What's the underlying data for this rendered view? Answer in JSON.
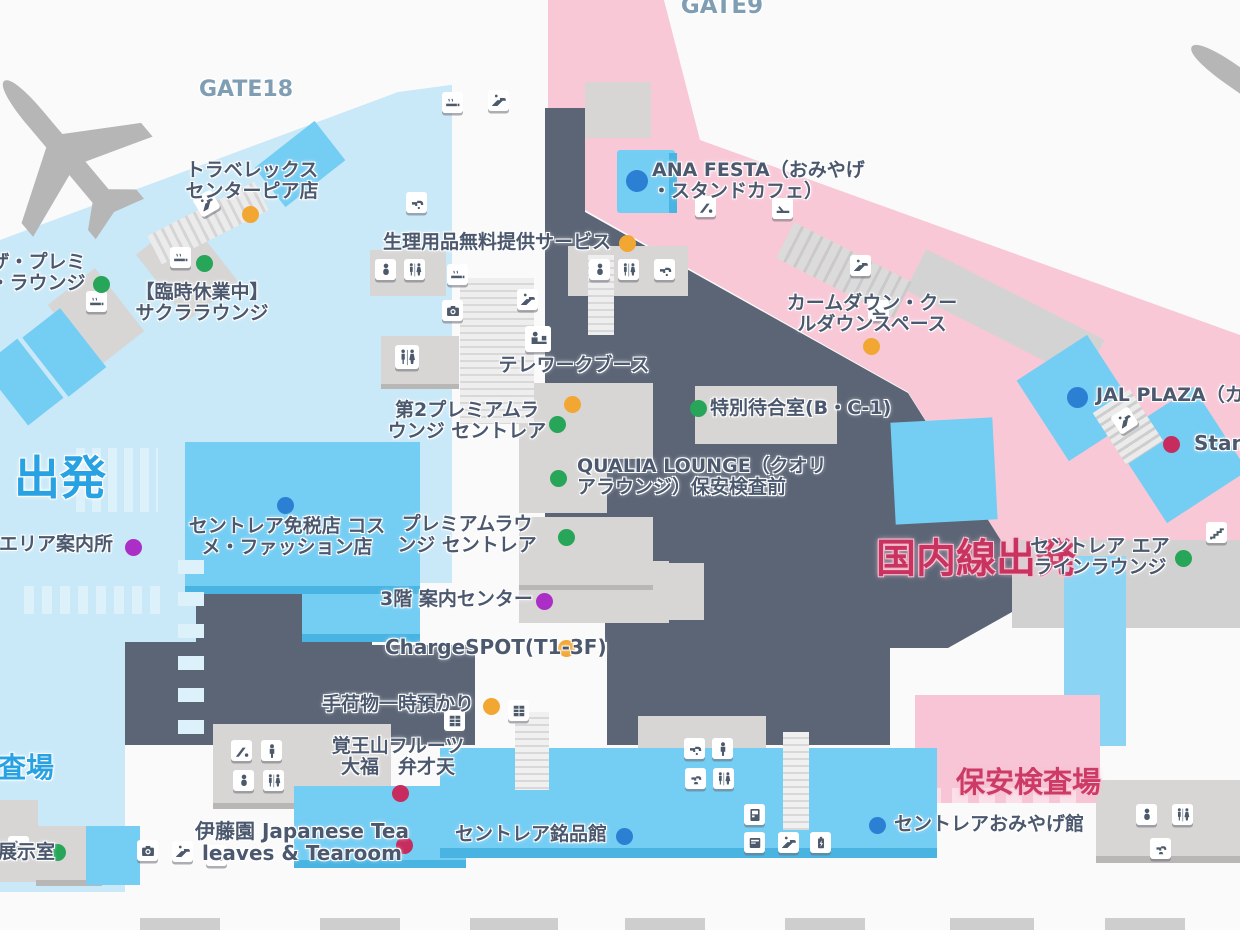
{
  "map": {
    "dot_colors": {
      "yellow": "#f2a733",
      "green": "#27a558",
      "blue": "#2b80d4",
      "purple": "#ab2fc6",
      "crimson": "#c62d5e"
    },
    "accent_colors": {
      "departures_blue": "#28a2e2",
      "domestic_crimson": "#c8335f",
      "gate_gray_blue": "#7f9db3",
      "international_area": "#c9e9f8",
      "domestic_area": "#f8c8d7",
      "secure_area": "#5b6576"
    },
    "labels": [
      {
        "id": "gate9-label",
        "lines": [
          "GATE9"
        ],
        "x": 722,
        "y": -6,
        "align": "center",
        "size": 23,
        "color": "#7f9db3"
      },
      {
        "id": "gate18-label",
        "lines": [
          "GATE18"
        ],
        "x": 246,
        "y": 78,
        "align": "center",
        "size": 22,
        "color": "#7f9db3"
      },
      {
        "id": "travelex-centrair-pier",
        "lines": [
          "トラベレックス",
          "センターピア店"
        ],
        "x": 252,
        "y": 160,
        "align": "center",
        "dot": {
          "color": "yellow",
          "x": 250,
          "y": 214
        }
      },
      {
        "id": "the-premium-lounge",
        "lines": [
          "ザ・プレミ",
          "・ラウンジ"
        ],
        "x": 38,
        "y": 252,
        "align": "center",
        "dot": {
          "color": "green",
          "x": 101,
          "y": 284
        }
      },
      {
        "id": "sakura-lounge-closed",
        "lines": [
          "【臨時休業中】",
          "サクララウンジ"
        ],
        "x": 202,
        "y": 282,
        "align": "center",
        "dot": {
          "color": "green",
          "x": 204,
          "y": 263
        }
      },
      {
        "id": "ana-festa-stand-cafe",
        "lines": [
          "ANA FESTA（おみやげ",
          "・スタンドカフェ）"
        ],
        "x": 652,
        "y": 160,
        "dot": {
          "color": "blue",
          "x": 637,
          "y": 181,
          "size": 22
        }
      },
      {
        "id": "sanitary-items-free-service",
        "lines": [
          "生理用品無料提供サービス"
        ],
        "x": 383,
        "y": 232,
        "dot": {
          "color": "yellow",
          "x": 627,
          "y": 243
        }
      },
      {
        "id": "calm-down-cool-down-space",
        "lines": [
          "カームダウン・クー",
          "ルダウンスペース"
        ],
        "x": 872,
        "y": 293,
        "align": "center",
        "dot": {
          "color": "yellow",
          "x": 871,
          "y": 346
        }
      },
      {
        "id": "telework-booth",
        "lines": [
          "テレワークブース"
        ],
        "x": 574,
        "y": 355,
        "align": "center",
        "dot": {
          "color": "yellow",
          "x": 572,
          "y": 404
        }
      },
      {
        "id": "premium-lounge-centrair-2",
        "lines": [
          "第2プレミアムラ",
          "ウンジ セントレア"
        ],
        "x": 467,
        "y": 400,
        "align": "center",
        "dot": {
          "color": "green",
          "x": 557,
          "y": 424
        }
      },
      {
        "id": "special-waiting-room",
        "lines": [
          "特別待合室(B・C-1)"
        ],
        "x": 710,
        "y": 398,
        "dot": {
          "color": "green",
          "x": 698,
          "y": 408
        }
      },
      {
        "id": "qualia-lounge",
        "lines": [
          "QUALIA LOUNGE（クオリ",
          "アラウンジ）保安検査前"
        ],
        "x": 577,
        "y": 456,
        "dot": {
          "color": "green",
          "x": 558,
          "y": 478
        }
      },
      {
        "id": "premium-lounge-centrair",
        "lines": [
          "プレミアムラウ",
          "ンジ セントレア"
        ],
        "x": 467,
        "y": 514,
        "align": "center",
        "dot": {
          "color": "green",
          "x": 566,
          "y": 537
        }
      },
      {
        "id": "centrair-duty-free-cosme-fashion",
        "lines": [
          "セントレア免税店 コス",
          "メ・ファッション店"
        ],
        "x": 287,
        "y": 516,
        "align": "center",
        "dot": {
          "color": "blue",
          "x": 285,
          "y": 505
        }
      },
      {
        "id": "restricted-area-info",
        "lines": [
          "限エリア案内所"
        ],
        "x": -20,
        "y": 534,
        "dot": {
          "color": "purple",
          "x": 133,
          "y": 547
        }
      },
      {
        "id": "departures-label",
        "lines": [
          "出発"
        ],
        "x": 14,
        "y": 453,
        "size": 46,
        "color": "#28a2e2"
      },
      {
        "id": "domestic-departures-label",
        "lines": [
          "国内線出発"
        ],
        "x": 876,
        "y": 537,
        "size": 40,
        "color": "#c8335f",
        "cls": "pinkhalo"
      },
      {
        "id": "jal-plaza-cafe",
        "lines": [
          "JAL PLAZA（カフ"
        ],
        "x": 1096,
        "y": 385,
        "dot": {
          "color": "blue",
          "x": 1077,
          "y": 397,
          "size": 21
        }
      },
      {
        "id": "stand-shop",
        "lines": [
          "Stand"
        ],
        "x": 1194,
        "y": 432,
        "size": 20,
        "dot": {
          "color": "crimson",
          "x": 1171,
          "y": 444
        }
      },
      {
        "id": "centrair-airline-lounge",
        "lines": [
          "セントレア エア",
          "ラインラウンジ"
        ],
        "x": 1100,
        "y": 536,
        "align": "center",
        "dot": {
          "color": "green",
          "x": 1183,
          "y": 558
        }
      },
      {
        "id": "info-center-3f",
        "lines": [
          "3階 案内センター"
        ],
        "x": 380,
        "y": 589,
        "dot": {
          "color": "purple",
          "x": 544,
          "y": 601
        }
      },
      {
        "id": "chargespot-t1-3f",
        "lines": [
          "ChargeSPOT(T1-3F)"
        ],
        "x": 385,
        "y": 636,
        "size": 20,
        "dot": {
          "color": "yellow",
          "x": 566,
          "y": 648
        }
      },
      {
        "id": "baggage-temporary-storage",
        "lines": [
          "手荷物一時預かり"
        ],
        "x": 322,
        "y": 694,
        "dot": {
          "color": "yellow",
          "x": 491,
          "y": 706
        }
      },
      {
        "id": "kakuozan-fruit-daifuku-benzaiten",
        "lines": [
          "覚王山フルーツ",
          "大福　弁才天"
        ],
        "x": 398,
        "y": 736,
        "align": "center",
        "dot": {
          "color": "crimson",
          "x": 400,
          "y": 793
        }
      },
      {
        "id": "itoen-japanese-tea-tearoom",
        "lines": [
          "伊藤園 Japanese Tea",
          "leaves & Tearoom"
        ],
        "x": 302,
        "y": 820,
        "align": "center",
        "size": 20,
        "dot": {
          "color": "crimson",
          "x": 404,
          "y": 845
        }
      },
      {
        "id": "centrair-meihinkan",
        "lines": [
          "セントレア銘品館"
        ],
        "x": 455,
        "y": 824,
        "dot": {
          "color": "blue",
          "x": 624,
          "y": 836
        }
      },
      {
        "id": "security-checkpoint-label",
        "lines": [
          "保安検査場"
        ],
        "x": 956,
        "y": 766,
        "size": 29,
        "color": "#cd3a66",
        "cls": "pinkhalo"
      },
      {
        "id": "centrair-omiyage-hall",
        "lines": [
          "セントレアおみやげ館"
        ],
        "x": 894,
        "y": 814,
        "dot": {
          "color": "blue",
          "x": 877,
          "y": 825
        }
      },
      {
        "id": "exhibition-room",
        "lines": [
          "展示室"
        ],
        "x": -2,
        "y": 842,
        "dot": {
          "color": "green",
          "x": 57,
          "y": 852
        }
      },
      {
        "id": "inspection-area-partial",
        "lines": [
          "検査場"
        ],
        "x": -30,
        "y": 752,
        "size": 28,
        "color": "#28a2e2"
      }
    ],
    "icons": [
      {
        "id": "smoking-room-icon",
        "g": "smoking",
        "x": 170,
        "y": 247
      },
      {
        "id": "escalator-icon",
        "g": "escalator",
        "x": 196,
        "y": 193,
        "rot": -30
      },
      {
        "id": "smoking-room-icon",
        "g": "smoking",
        "x": 86,
        "y": 291
      },
      {
        "id": "smoking-room-icon",
        "g": "smoking",
        "x": 442,
        "y": 92
      },
      {
        "id": "escalator-icon",
        "g": "escalator",
        "x": 488,
        "y": 90
      },
      {
        "id": "faucet-icon",
        "g": "faucet",
        "x": 406,
        "y": 192
      },
      {
        "id": "baby-care-icon",
        "g": "baby",
        "x": 375,
        "y": 259
      },
      {
        "id": "restroom-icon",
        "g": "restroom",
        "x": 404,
        "y": 259
      },
      {
        "id": "smoking-room-icon",
        "g": "smoking",
        "x": 447,
        "y": 264
      },
      {
        "id": "photo-booth-icon",
        "g": "photo",
        "x": 442,
        "y": 300
      },
      {
        "id": "restroom-icon",
        "g": "restroom",
        "x": 395,
        "y": 345,
        "size": 24
      },
      {
        "id": "escalator-icon",
        "g": "escalator",
        "x": 517,
        "y": 289
      },
      {
        "id": "telework-booth-icon",
        "g": "telework",
        "x": 525,
        "y": 326,
        "size": 26
      },
      {
        "id": "baby-care-icon",
        "g": "baby",
        "x": 589,
        "y": 259
      },
      {
        "id": "restroom-icon",
        "g": "restroom",
        "x": 618,
        "y": 259
      },
      {
        "id": "faucet-icon",
        "g": "faucet",
        "x": 654,
        "y": 259
      },
      {
        "id": "kids-play-area-icon",
        "g": "slide",
        "x": 695,
        "y": 196
      },
      {
        "id": "relaxation-seat-icon",
        "g": "seat",
        "x": 772,
        "y": 198
      },
      {
        "id": "escalator-icon",
        "g": "escalator",
        "x": 850,
        "y": 255
      },
      {
        "id": "calm-down-room-icon",
        "g": "seat",
        "x": 868,
        "y": 300
      },
      {
        "id": "escalator-icon",
        "g": "escalator",
        "x": 1114,
        "y": 410,
        "rot": -33
      },
      {
        "id": "stairs-icon",
        "g": "stairs",
        "x": 1206,
        "y": 522
      },
      {
        "id": "coin-locker-icon",
        "g": "locker",
        "x": 444,
        "y": 710
      },
      {
        "id": "coin-locker-icon",
        "g": "locker",
        "x": 508,
        "y": 700
      },
      {
        "id": "kids-slide-icon",
        "g": "slide",
        "x": 231,
        "y": 740
      },
      {
        "id": "mens-room-icon",
        "g": "man",
        "x": 261,
        "y": 740
      },
      {
        "id": "baby-care-icon",
        "g": "baby",
        "x": 233,
        "y": 770
      },
      {
        "id": "restroom-icon",
        "g": "restroom",
        "x": 263,
        "y": 770
      },
      {
        "id": "faucet-icon",
        "g": "faucet",
        "x": 684,
        "y": 738
      },
      {
        "id": "mens-room-icon",
        "g": "man",
        "x": 712,
        "y": 738
      },
      {
        "id": "drinking-fountain-icon",
        "g": "fountain",
        "x": 685,
        "y": 768
      },
      {
        "id": "restroom-icon",
        "g": "restroom",
        "x": 713,
        "y": 768
      },
      {
        "id": "vending-machine-icon",
        "g": "vending",
        "x": 744,
        "y": 804
      },
      {
        "id": "atm-icon",
        "g": "atm",
        "x": 744,
        "y": 832
      },
      {
        "id": "escalator-icon",
        "g": "escalator",
        "x": 778,
        "y": 832
      },
      {
        "id": "charging-station-icon",
        "g": "charging",
        "x": 810,
        "y": 832
      },
      {
        "id": "photo-booth-icon",
        "g": "photo",
        "x": 137,
        "y": 840
      },
      {
        "id": "escalator-icon",
        "g": "escalator",
        "x": 172,
        "y": 841
      },
      {
        "id": "atm-icon",
        "g": "atm",
        "x": 206,
        "y": 845
      },
      {
        "id": "escalator-icon",
        "g": "escalator",
        "x": 8,
        "y": 836
      },
      {
        "id": "baby-care-icon",
        "g": "baby",
        "x": 1136,
        "y": 804
      },
      {
        "id": "restroom-icon",
        "g": "restroom",
        "x": 1172,
        "y": 804
      },
      {
        "id": "drinking-fountain-icon",
        "g": "fountain",
        "x": 1150,
        "y": 838
      }
    ]
  }
}
